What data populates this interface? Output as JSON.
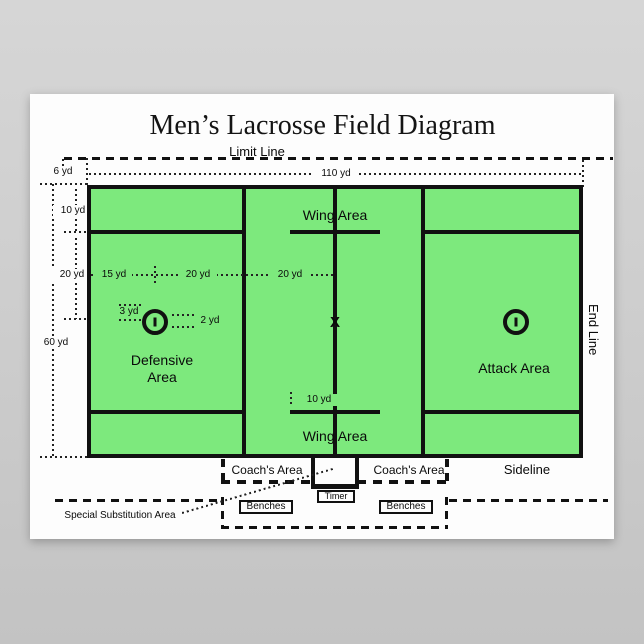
{
  "title": "Men’s Lacrosse Field Diagram",
  "boundary": {
    "limit_line": "Limit Line",
    "end_line": "End Line",
    "sideline": "Sideline"
  },
  "dims": {
    "d110": "110 yd",
    "d6": "6 yd",
    "d10": "10 yd",
    "d20": "20 yd",
    "d60": "60 yd",
    "d15": "15 yd",
    "d20b": "20 yd",
    "d20c": "20 yd",
    "d3": "3 yd",
    "d2": "2 yd",
    "d10wing": "10 yd"
  },
  "areas": {
    "wing": "Wing Area",
    "defensive1": "Defensive",
    "defensive2": "Area",
    "attack": "Attack Area"
  },
  "bench_zone": {
    "coach": "Coach's Area",
    "timer": "Timer",
    "benches": "Benches",
    "special_sub": "Special Substitution Area"
  },
  "symbols": {
    "faceoff_x": "X"
  },
  "colors": {
    "field_green": "#7de97d",
    "line_black": "#111111",
    "background_gray": "#c9c9c9",
    "poster_white": "#fdfdfd"
  }
}
